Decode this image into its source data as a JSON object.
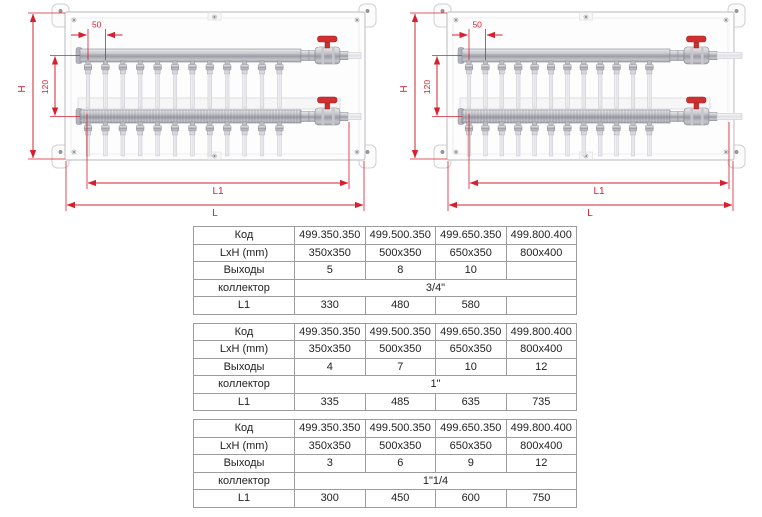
{
  "colors": {
    "dimension_red": "#d6202f",
    "valve_handle_red": "#d23030",
    "metal_gray": "#9b9ba4",
    "table_border_gray": "#9c9c9c"
  },
  "diagrams": [
    {
      "id": "left",
      "outlets": 12,
      "labels": {
        "H": "H",
        "vertical_pitch": "120",
        "outlet_pitch": "50",
        "L1": "L1",
        "L": "L"
      }
    },
    {
      "id": "right",
      "outlets": 12,
      "labels": {
        "H": "H",
        "vertical_pitch": "120",
        "outlet_pitch": "50",
        "L1": "L1",
        "L": "L"
      }
    }
  ],
  "tables": [
    {
      "name": "collector-3-4-inch",
      "rows": [
        {
          "label": "Код",
          "values": [
            "499.350.350",
            "499.500.350",
            "499.650.350",
            "499.800.400"
          ]
        },
        {
          "label": "LxH (mm)",
          "values": [
            "350x350",
            "500x350",
            "650x350",
            "800x400"
          ]
        },
        {
          "label": "Выходы",
          "values": [
            "5",
            "8",
            "10",
            ""
          ]
        },
        {
          "label": "коллектор",
          "span_value": "3/4\""
        },
        {
          "label": "L1",
          "values": [
            "330",
            "480",
            "580",
            ""
          ]
        }
      ]
    },
    {
      "name": "collector-1-inch",
      "rows": [
        {
          "label": "Код",
          "values": [
            "499.350.350",
            "499.500.350",
            "499.650.350",
            "499.800.400"
          ]
        },
        {
          "label": "LxH (mm)",
          "values": [
            "350x350",
            "500x350",
            "650x350",
            "800x400"
          ]
        },
        {
          "label": "Выходы",
          "values": [
            "4",
            "7",
            "10",
            "12"
          ]
        },
        {
          "label": "коллектор",
          "span_value": "1\""
        },
        {
          "label": "L1",
          "values": [
            "335",
            "485",
            "635",
            "735"
          ]
        }
      ]
    },
    {
      "name": "collector-1-1-4-inch",
      "rows": [
        {
          "label": "Код",
          "values": [
            "499.350.350",
            "499.500.350",
            "499.650.350",
            "499.800.400"
          ]
        },
        {
          "label": "LxH (mm)",
          "values": [
            "350x350",
            "500x350",
            "650x350",
            "800x400"
          ]
        },
        {
          "label": "Выходы",
          "values": [
            "3",
            "6",
            "9",
            "12"
          ]
        },
        {
          "label": "коллектор",
          "span_value": "1\"1/4"
        },
        {
          "label": "L1",
          "values": [
            "300",
            "450",
            "600",
            "750"
          ]
        }
      ]
    }
  ]
}
